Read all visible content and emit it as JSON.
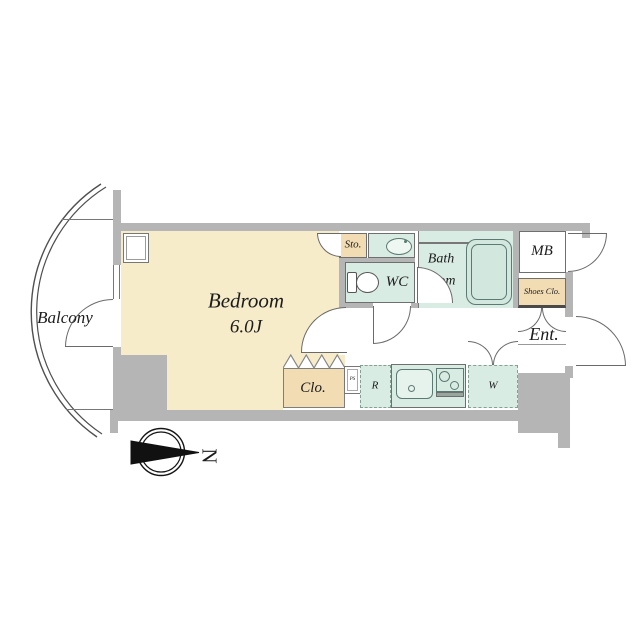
{
  "labels": {
    "balcony": "Balcony",
    "bedroom": "Bedroom",
    "bedroom_size": "6.0J",
    "storage": "Sto.",
    "toilet": "WC",
    "bath_line1": "Bath",
    "bath_line2": "room",
    "meter_box": "MB",
    "shoes_closet": "Shoes Clo.",
    "entrance": "Ent.",
    "closet": "Clo.",
    "refrigerator": "R",
    "washer": "W",
    "pipe_space": "PS",
    "compass_north": "N"
  },
  "colors": {
    "wall": "#b5b5b5",
    "bedroom_fill": "#f6ecca",
    "closet_fill": "#f2dcb4",
    "wet_area_fill": "#d9ece4",
    "outline": "#6a6a6a",
    "background": "#ffffff"
  }
}
